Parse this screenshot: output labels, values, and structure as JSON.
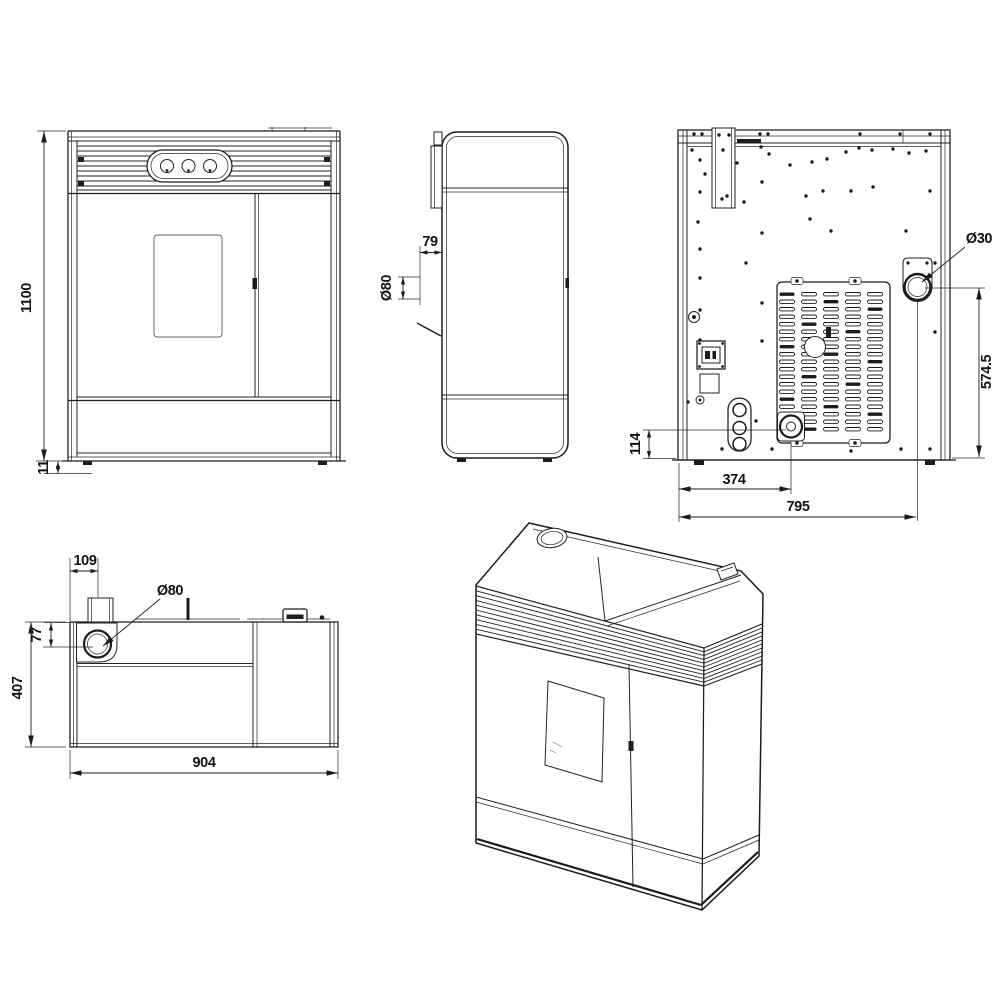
{
  "colors": {
    "background": "#ffffff",
    "line": "#1c1c1c",
    "text": "#141414"
  },
  "views": {
    "front": {
      "dims": {
        "overall_height": "1100",
        "base_height": "11"
      }
    },
    "side": {
      "dims": {
        "flue_offset": "79",
        "flue_diameter": "Ø80"
      }
    },
    "back": {
      "dims": {
        "port_diameter": "Ø30",
        "port_height": "574.5",
        "intake_height": "114",
        "intake_offset": "374",
        "port_offset": "795"
      }
    },
    "top": {
      "dims": {
        "flue_side_offset": "109",
        "flue_diameter": "Ø80",
        "flue_front_offset": "77",
        "depth": "407",
        "width": "904"
      }
    }
  }
}
